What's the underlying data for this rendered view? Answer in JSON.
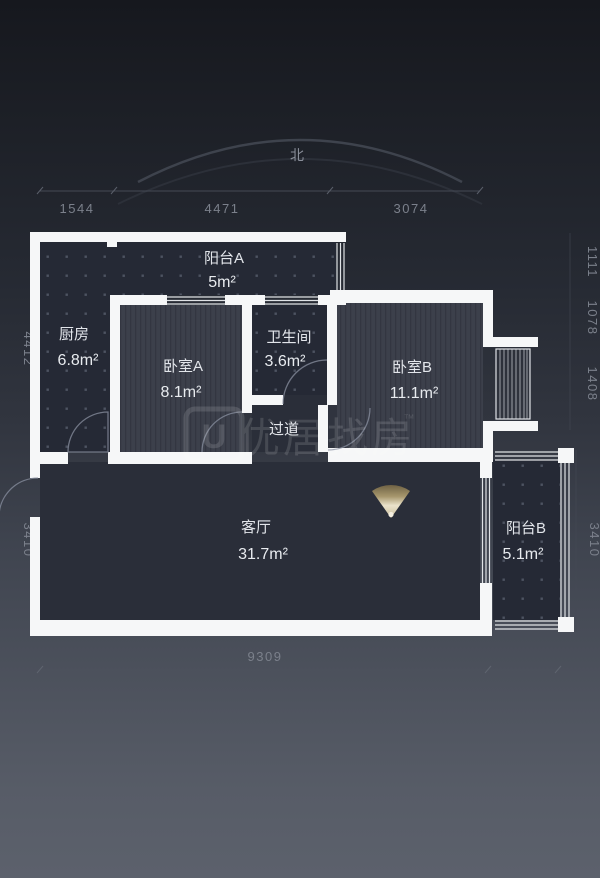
{
  "compass": {
    "north_label": "北"
  },
  "rooms": {
    "balcony_a": {
      "name": "阳台A",
      "area": "5m²"
    },
    "kitchen": {
      "name": "厨房",
      "area": "6.8m²"
    },
    "bedroom_a": {
      "name": "卧室A",
      "area": "8.1m²"
    },
    "bathroom": {
      "name": "卫生间",
      "area": "3.6m²"
    },
    "bedroom_b": {
      "name": "卧室B",
      "area": "11.1m²"
    },
    "hallway": {
      "name": "过道"
    },
    "living_room": {
      "name": "客厅",
      "area": "31.7m²"
    },
    "balcony_b": {
      "name": "阳台B",
      "area": "5.1m²"
    }
  },
  "dimensions": {
    "top": {
      "d1": "1544",
      "d2": "4471",
      "d3": "3074"
    },
    "bottom": {
      "d1": "9309"
    },
    "left": {
      "d1": "4412",
      "d2": "3410"
    },
    "right": {
      "d1": "1111",
      "d2": "1078",
      "d3": "1408",
      "d4": "3410"
    }
  },
  "watermark": {
    "logo_letter": "U",
    "brand": "优居找房",
    "trademark": "™"
  },
  "colors": {
    "wall": "#f6f7f8",
    "tile_floor": "#252935",
    "wood_floor": "#3c404b",
    "living_floor": "#2a2e39",
    "light_accent": "#eae2cb",
    "dim_text": "#7b808b",
    "room_text": "#e2e5ea"
  }
}
